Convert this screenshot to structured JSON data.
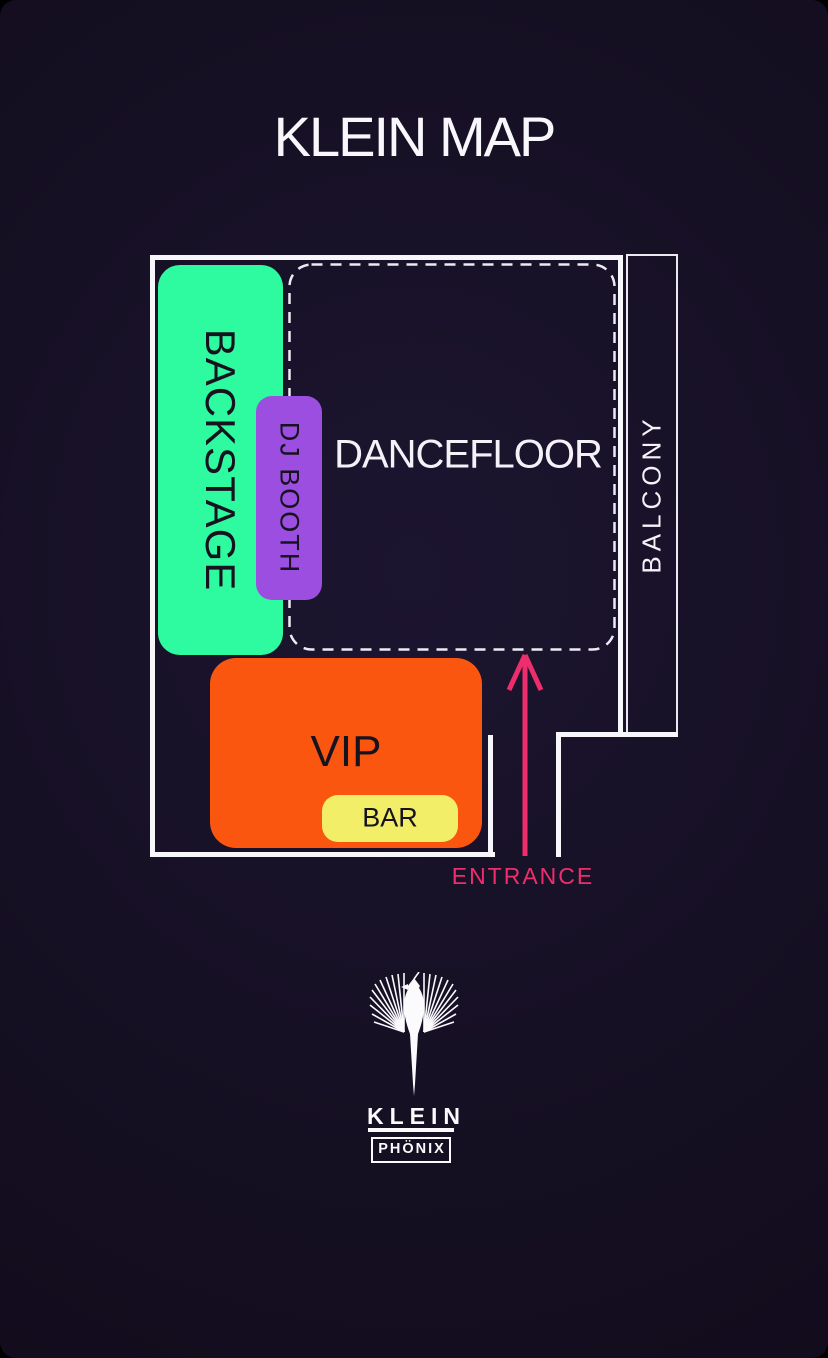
{
  "page": {
    "title": "KLEIN MAP",
    "background": "#150F22"
  },
  "map": {
    "wall_color": "#F7F6FA",
    "backstage": {
      "label": "BACKSTAGE",
      "color": "#2EFA9F"
    },
    "dj_booth": {
      "label": "DJ BOOTH",
      "color": "#9C4EE0"
    },
    "dancefloor": {
      "label": "DANCEFLOOR",
      "border_style": "dashed-white"
    },
    "balcony": {
      "label": "BALCONY",
      "border_style": "solid-white"
    },
    "vip": {
      "label": "VIP",
      "color": "#FB560F"
    },
    "bar": {
      "label": "BAR",
      "color": "#F2EE67"
    },
    "entrance": {
      "label": "ENTRANCE",
      "color": "#EE2E6C"
    }
  },
  "logo": {
    "title": "KLEIN",
    "subtitle": "PHÖNIX"
  }
}
